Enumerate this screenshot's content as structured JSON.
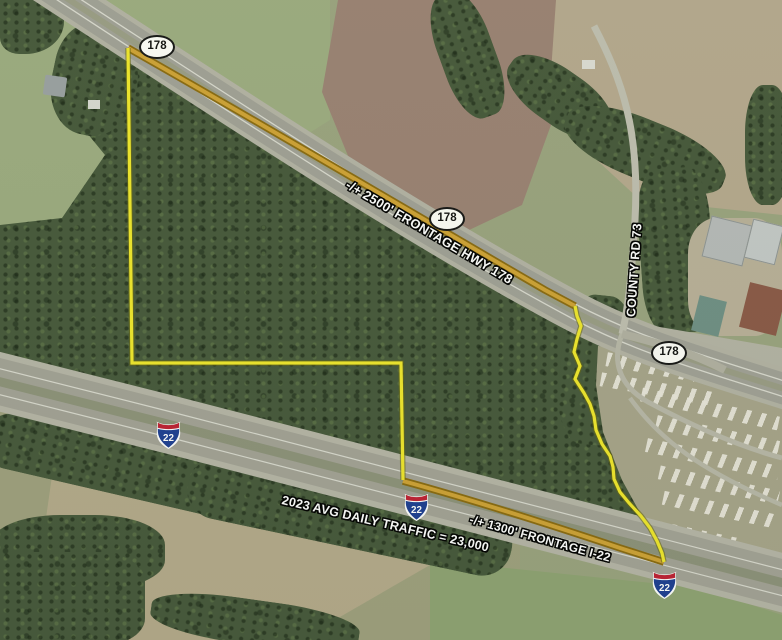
{
  "map": {
    "description": "Aerial parcel map with highway frontage annotations",
    "labels": {
      "frontage_hwy178": "-/+ 2500' FRONTAGE HWY 178",
      "frontage_i22": "-/+ 1300' FRONTAGE I-22",
      "traffic": "2023 AVG DAILY TRAFFIC = 23,000",
      "county_rd": "COUNTY RD 73"
    },
    "shields": {
      "hwy_number": "178",
      "interstate_number": "22"
    },
    "colors": {
      "parcel_outline": "#f0e72c",
      "frontage_highlight": "#cfa235"
    }
  }
}
